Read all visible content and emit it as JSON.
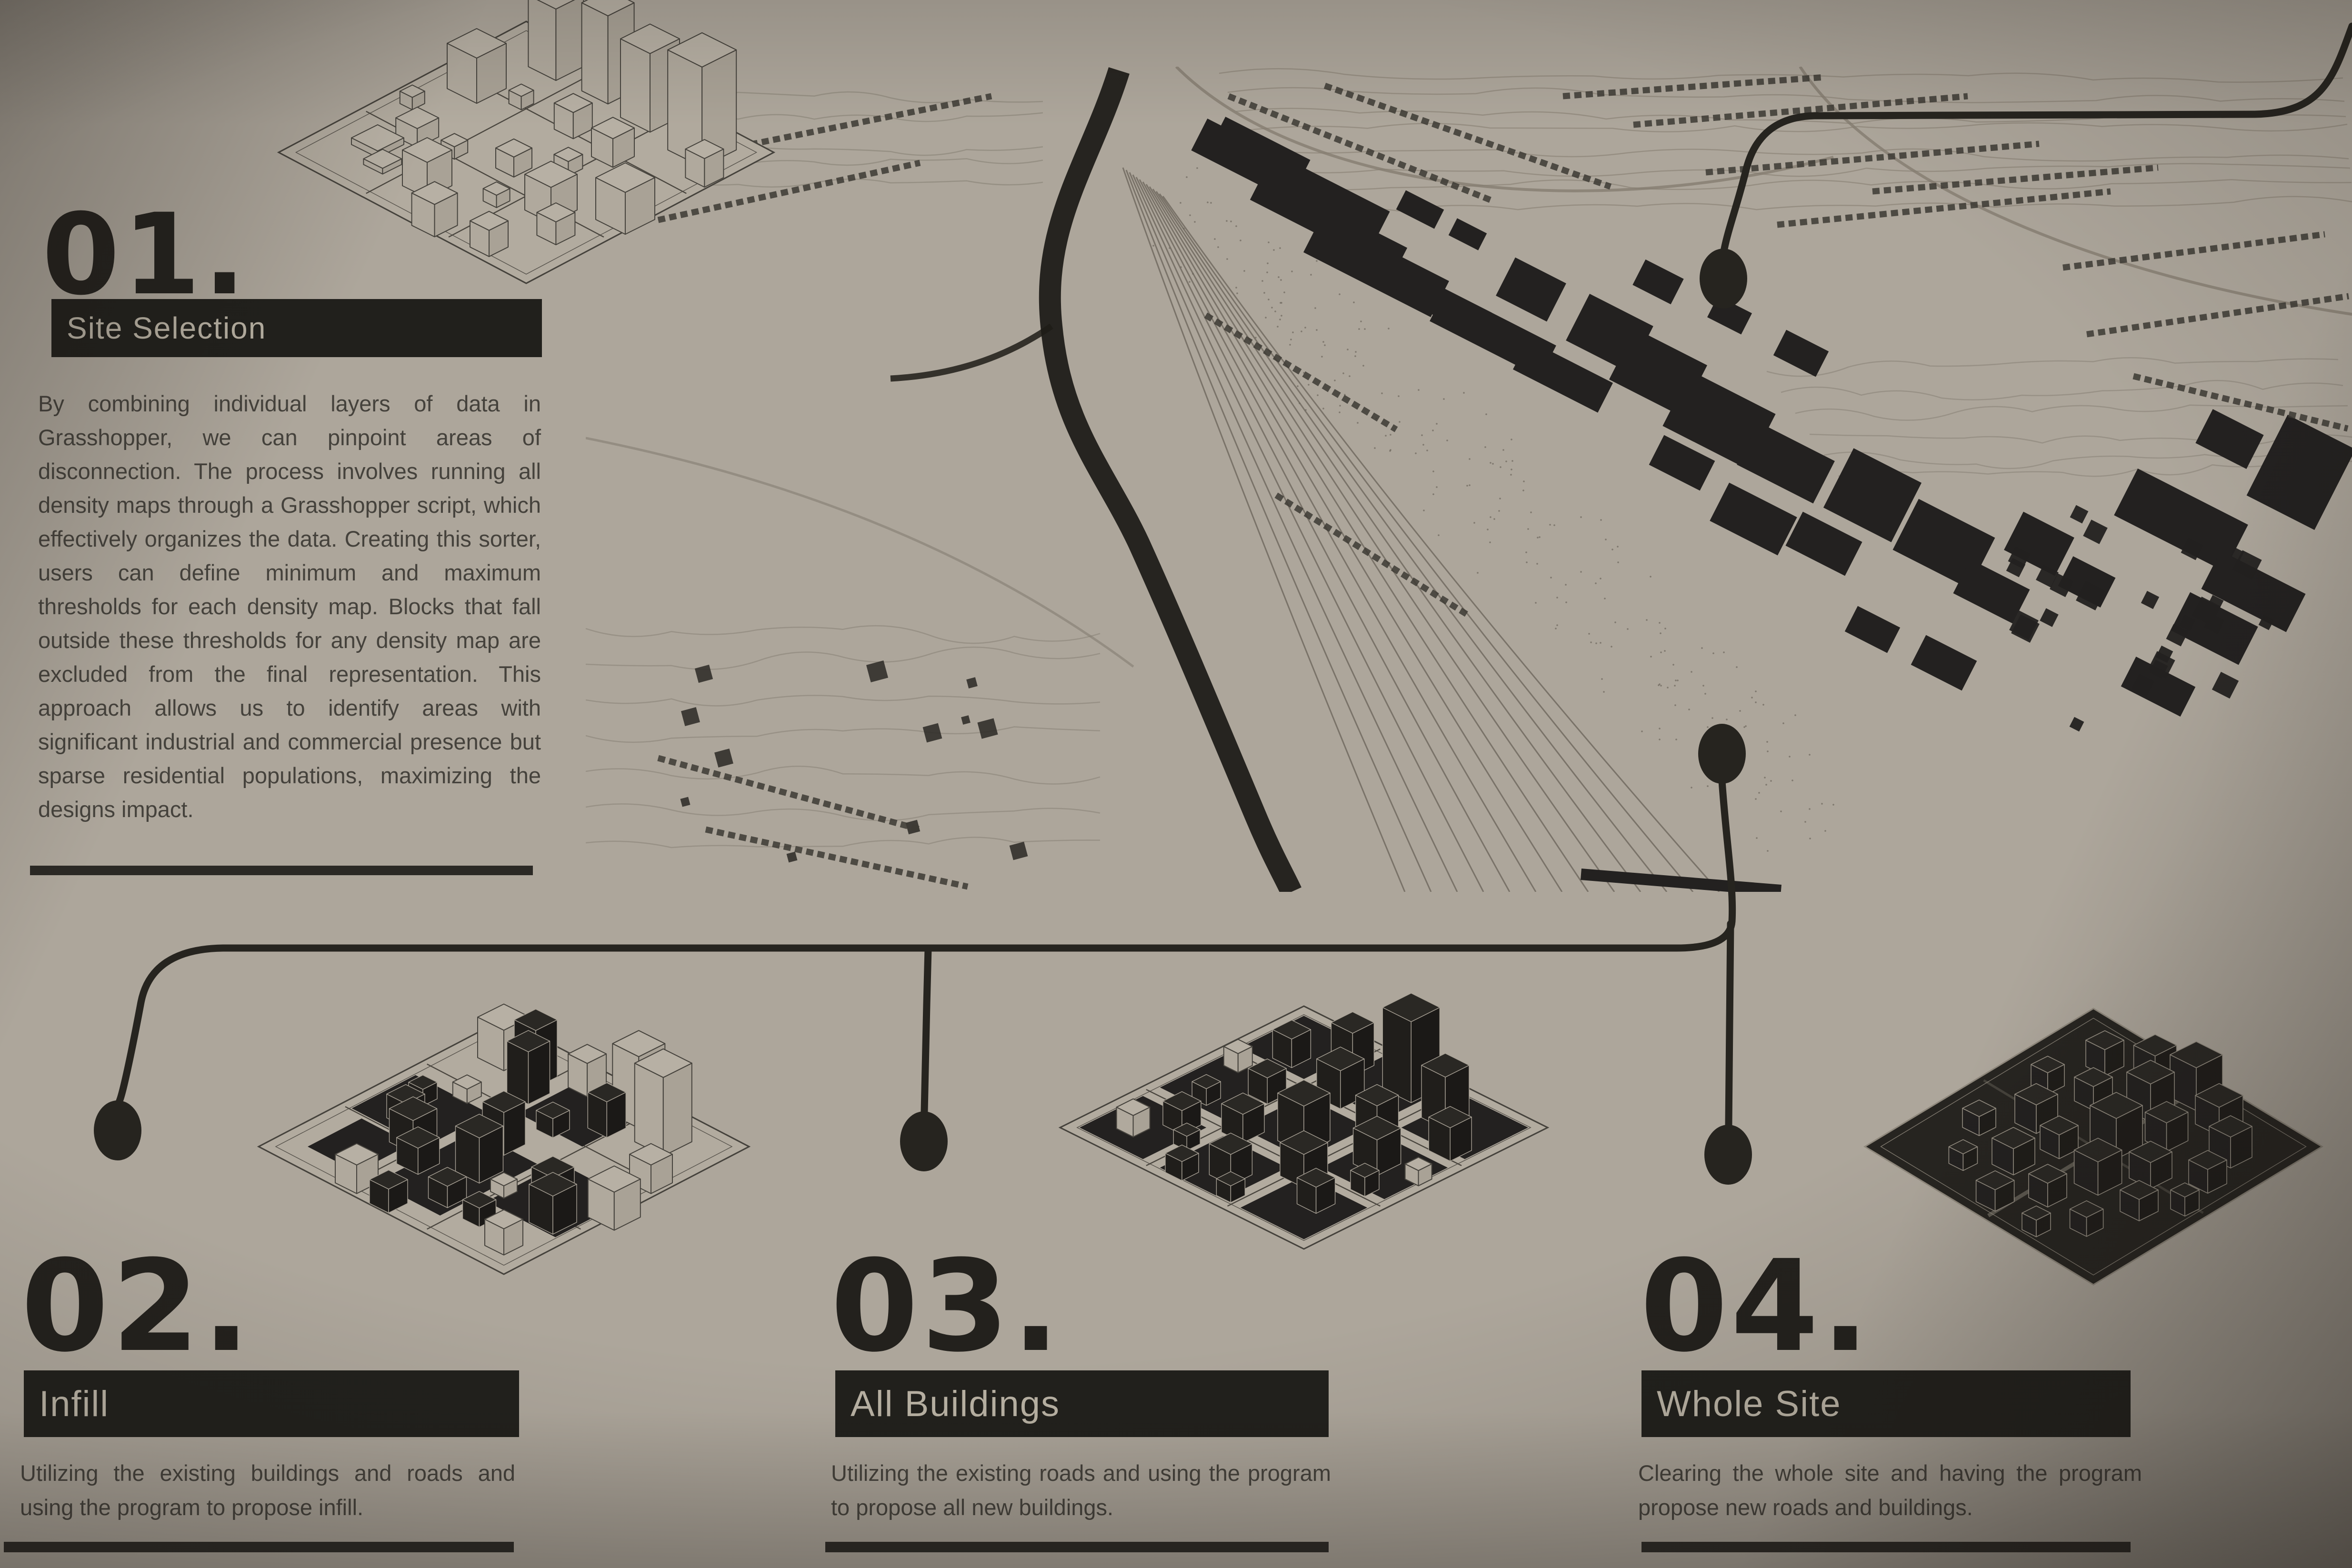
{
  "board": {
    "steps": [
      {
        "number": "01.",
        "title": "Site Selection",
        "description": "By combining individual layers of data in Grasshopper, we can pinpoint areas of disconnection. The process involves running all density maps through a Grasshopper script, which effectively organizes the data. Creating this sorter, users can define minimum and maximum thresholds for each density map. Blocks that fall outside these thresholds for any density map are excluded from the final representation. This approach allows us to identify areas with significant industrial and commercial presence but sparse residential populations, maximizing the designs impact."
      },
      {
        "number": "02.",
        "title": "Infill",
        "description": "Utilizing the existing buildings and roads and using the program to propose infill."
      },
      {
        "number": "03.",
        "title": "All Buildings",
        "description": "Utilizing the existing roads and using the program to propose all new buildings."
      },
      {
        "number": "04.",
        "title": "Whole Site",
        "description": "Clearing the whole site and having the program propose new roads and buildings."
      }
    ],
    "graphics": {
      "site_map": "axonometric-city-site-map",
      "step1_diagram": "wireframe-block-model",
      "step2_diagram": "infill-block-model",
      "step3_diagram": "all-new-buildings-block-model",
      "step4_diagram": "whole-site-black-block-model",
      "connector_style": "line-with-endpoint-dots"
    },
    "colors": {
      "background": "#ada69b",
      "ink": "#23211d",
      "bar_background": "#21201c",
      "bar_text": "#b8b1a3",
      "body_text": "#45423c",
      "connector": "#26241f"
    }
  }
}
